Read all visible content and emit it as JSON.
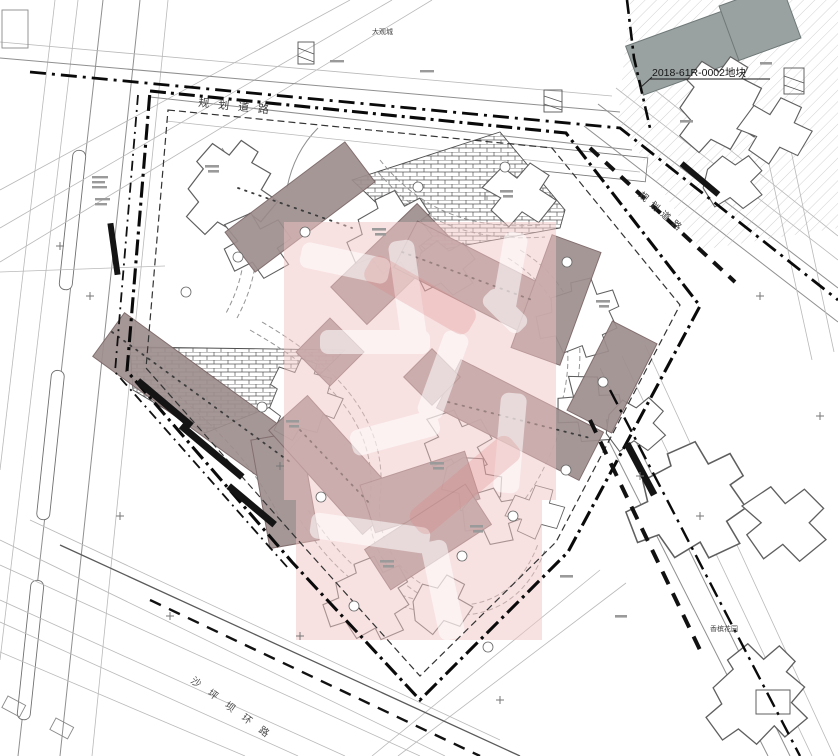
{
  "labels": {
    "town_name": "大观城",
    "road_top": "规划道路",
    "road_right": "规划道路",
    "road_bottom_left": "沙坪坝环路",
    "parcel_code": "2018-61R-0002地块",
    "neighborhood": "香槟花园"
  },
  "colors": {
    "background": "#ffffff",
    "drawing_line": "#555555",
    "boundary": "#0a0a0a",
    "watermark_pink": "#f2c4c4",
    "building_bar": "#9f8e8e",
    "bar_outline": "#776262",
    "gray_roof": "#9aa1a1",
    "footprint_outline": "#5f5f5f"
  }
}
